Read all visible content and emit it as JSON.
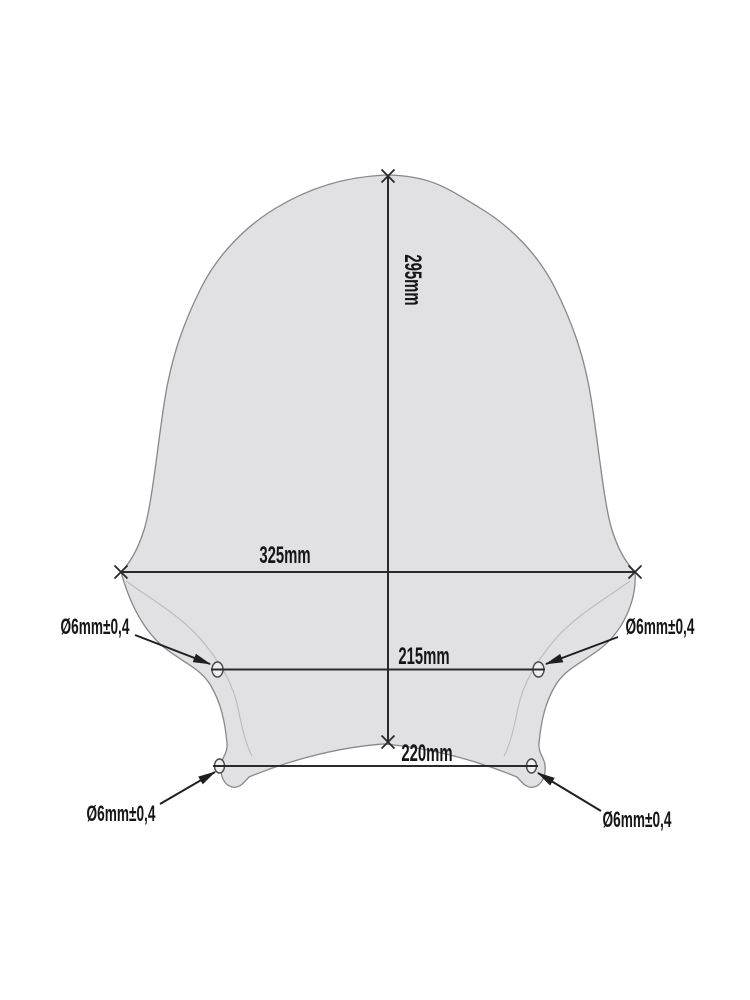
{
  "page": {
    "background_color": "#ffffff"
  },
  "diagram": {
    "colors": {
      "shape_fill": "#e1e1e3",
      "shape_outline": "#88888b",
      "surface_contour": "#bdbdc0",
      "dimension_line": "#2a2a2c",
      "label_text": "#161618"
    },
    "dimensions": {
      "height": "295mm",
      "max_width": "325mm",
      "upper_hole_spacing": "215mm",
      "lower_hole_spacing": "220mm"
    },
    "holes": {
      "top_left_label": "Ø6mm±0,4",
      "top_right_label": "Ø6mm±0,4",
      "bottom_left_label": "Ø6mm±0,4",
      "bottom_right_label": "Ø6mm±0,4"
    }
  }
}
